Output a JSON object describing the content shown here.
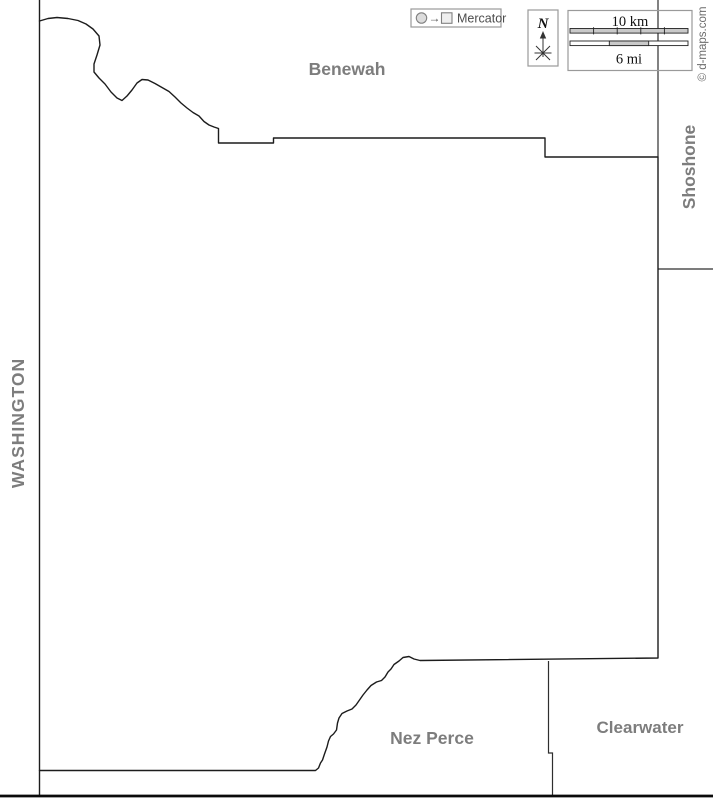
{
  "neighbors": {
    "benewah": "Benewah",
    "washington": "WASHINGTON",
    "shoshone": "Shoshone",
    "nez_perce": "Nez Perce",
    "clearwater": "Clearwater"
  },
  "legend": {
    "projection_label": "Mercator",
    "arrow_glyph": "→"
  },
  "compass": {
    "north_label": "N"
  },
  "scale": {
    "km_label": "10 km",
    "mi_label": "6 mi"
  },
  "credit": {
    "text": "© d-maps.com"
  },
  "colors": {
    "label_gray": "#7d7d7d",
    "county_border": "#1c1c1c",
    "neighbor_line": "#2e2e2e",
    "thick_base_line": "#0a0a0a",
    "box_border": "#9a9a9a",
    "bar_gray": "#c9c9c9",
    "bar_edge": "#222222",
    "legend_shape_fill": "#dcdcdc",
    "legend_text": "#4d4d4d",
    "credit_gray": "#6b6b6b"
  },
  "map": {
    "boundaries": {
      "washington_state_line": "M 39.5 0 L 39.5 796",
      "latah_outline": "M 39.5 21 L 48 18.5 L 57 17.5 L 68 18.5 L 78 20.5 L 86 24 L 93 29 L 99 36 L 100 45 L 97 55 L 94 64 L 94 72 L 99 78 L 105 84 L 111 92 L 117 98 L 122 100.5 L 127 96 L 132 90 L 137 83 L 142 79.5 L 148 80 L 155 83.5 L 162 87.5 L 169 91.5 L 175 97 L 181 103 L 187 108 L 193 112.5 L 199 116 L 204 121.5 L 209 125 L 214 127 L 218.5 128.5 L 218.5 143 L 273.5 143 L 273.5 138 L 545 138 L 545 157 L 658 157 L 658 658 L 420 660.5 L 414 659 L 409 656.5 L 403 657.5 L 399 661 L 394 664.5 L 391 669 L 388 672 L 385 677 L 381.5 680.5 L 376.5 682 L 371 685.5 L 367 690 L 363 695 L 359.5 700 L 356 705 L 352 709 L 347 711 L 342 713.5 L 339 718 L 337.5 723 L 336.5 730 L 333.5 734 L 330.5 736.5 L 328.5 741 L 327 747 L 324.5 754 L 322.5 760 L 320.5 763 L 318.5 768 L 315.5 770.5 L 39.5 770.5",
      "benewah_shoshone_line": "M 658 0 L 658 157",
      "shoshone_clearwater_line": "M 658 269 L 713 269",
      "nezperce_clearwater_line": "M 548.5 661 L 548.5 753 L 552.5 753 L 552.5 795",
      "south_base_line": "M 0 796 L 713 796"
    }
  }
}
